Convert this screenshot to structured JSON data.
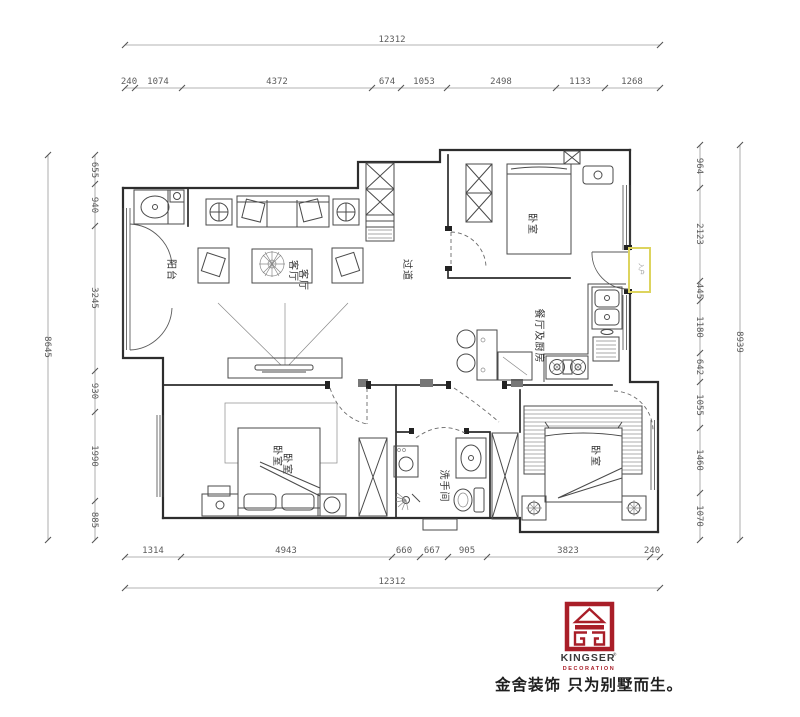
{
  "dimensions": {
    "top_total": "12312",
    "top_segments": [
      "240",
      "1074",
      "4372",
      "674",
      "1053",
      "2498",
      "1133",
      "1268"
    ],
    "bottom_segments": [
      "1314",
      "4943",
      "660",
      "667",
      "905",
      "3823",
      "240"
    ],
    "bottom_total": "12312",
    "left_total": "8645",
    "left_segments": [
      "655",
      "940",
      "3245",
      "930",
      "1990",
      "885"
    ],
    "right_total": "8939",
    "right_segments": [
      "964",
      "2123",
      "445",
      "1180",
      "642",
      "1055",
      "1460",
      "1070"
    ]
  },
  "rooms": {
    "balcony": "阳台",
    "living": "客厅",
    "hallway": "过道",
    "bedroom_top": "卧室",
    "kitchen_dining": "餐厅及厨房",
    "bedroom_left": "卧室",
    "bathroom": "洗手间",
    "bedroom_right": "卧室",
    "entry": "入户"
  },
  "logo": {
    "brand": "KINGSER",
    "reg": "®",
    "sub": "DECORATION",
    "tagline": "金舍装饰 只为别墅而生。",
    "red": "#a91e28"
  },
  "colors": {
    "line": "#2d2d2d",
    "dim_line": "#9a9a9a",
    "highlight": "#ddd45e"
  }
}
